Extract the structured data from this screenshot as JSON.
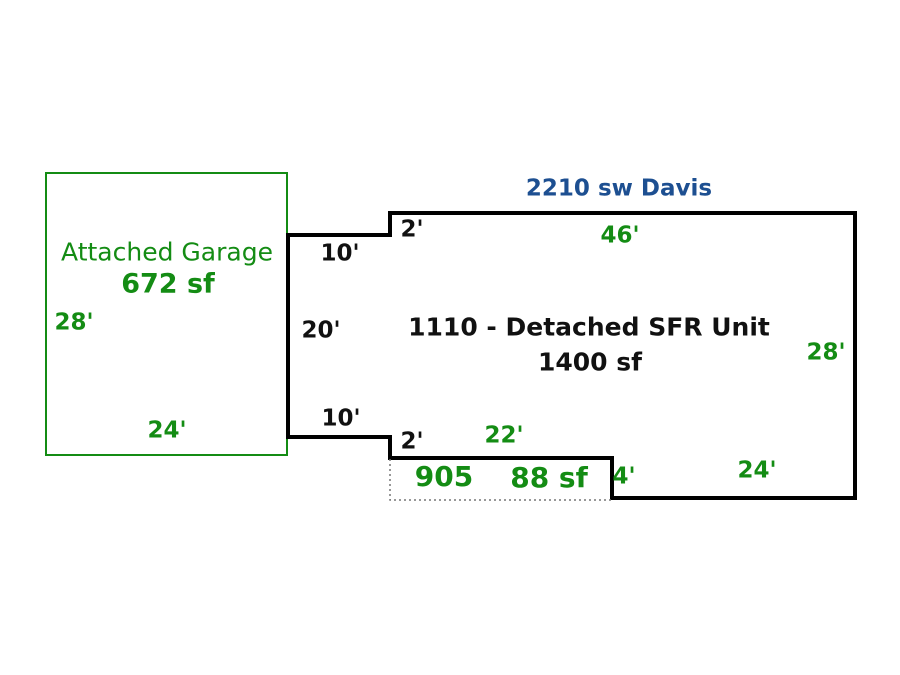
{
  "sketch": {
    "address": "2210 sw Davis",
    "garage": {
      "label": "Attached Garage",
      "area": "672 sf",
      "dim_left": "28'",
      "dim_bottom": "24'"
    },
    "unit": {
      "label": "1110 - Detached SFR Unit",
      "area": "1400 sf",
      "dim_step_top": "2'",
      "dim_top": "46'",
      "dim_right": "28'",
      "dim_left_upper": "10'",
      "dim_left_mid": "20'",
      "dim_left_lower": "10'",
      "dim_step_bottom": "2'",
      "dim_bottom_right": "24'"
    },
    "porch": {
      "code": "905",
      "area": "88 sf",
      "dim_top": "22'",
      "dim_right": "4'"
    },
    "colors": {
      "green": "#148C14",
      "blue": "#1D4F91",
      "ink": "#111111",
      "outline": "#000000",
      "dotted": "#777777"
    }
  }
}
